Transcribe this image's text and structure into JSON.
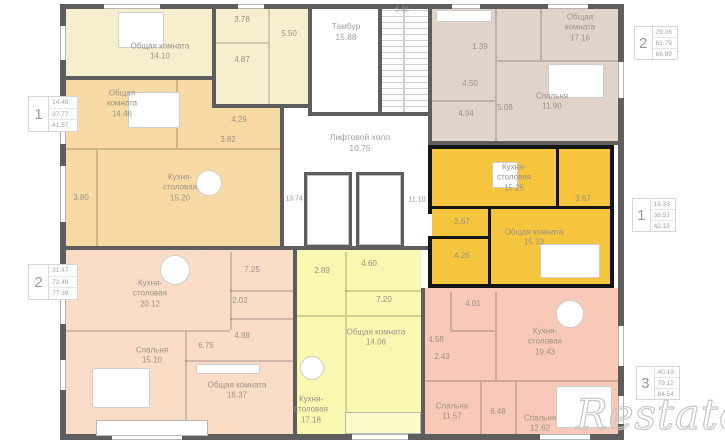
{
  "watermark": "Restate",
  "colors": {
    "selected_unit": "#f4c53d",
    "selected_walls": "#151515",
    "unit_cream": "#f6eecd",
    "unit_orange": "#f8dba4",
    "unit_pink": "#fbdcc6",
    "unit_yellow": "#f8f8b0",
    "unit_salmon": "#f8c9b8",
    "unit_beige": "#e2d3c8",
    "walls": "#5e5e5e",
    "label_text": "#9b9389"
  },
  "common_areas": {
    "tambour": {
      "name": "Тамбур",
      "area": "15.88"
    },
    "lift_hall": {
      "name": "Лифтовой холл",
      "area": "10.75"
    },
    "corridor_left_area": "13.74",
    "corridor_right_area": "11.10",
    "top_area": "5.40"
  },
  "units": [
    {
      "id": "cream-top-left",
      "rooms": [
        {
          "name": "Общая комната",
          "area": "14.10"
        },
        {
          "area": "3.78"
        },
        {
          "area": "4.87"
        },
        {
          "area": "5.50"
        }
      ]
    },
    {
      "id": "orange-mid-left",
      "rooms": [
        {
          "name": "Общая комната",
          "area": "14.46"
        },
        {
          "area": "4.29"
        },
        {
          "area": "3.82"
        },
        {
          "name": "Кухня-столовая",
          "area": "15.20"
        },
        {
          "area": "3.80"
        }
      ]
    },
    {
      "id": "pink-bottom-left",
      "rooms": [
        {
          "name": "Кухня-столовая",
          "area": "20.12"
        },
        {
          "area": "7.25"
        },
        {
          "area": "2.02"
        },
        {
          "area": "4.88"
        },
        {
          "area": "6.75"
        },
        {
          "name": "Спальня",
          "area": "15.10"
        },
        {
          "name": "Общая комната",
          "area": "16.37"
        }
      ]
    },
    {
      "id": "yellow-bottom-middle",
      "rooms": [
        {
          "area": "2.89"
        },
        {
          "area": "4.60"
        },
        {
          "area": "7.20"
        },
        {
          "name": "Общая комната",
          "area": "14.06"
        },
        {
          "name": "Кухня-столовая",
          "area": "17.18"
        }
      ]
    },
    {
      "id": "salmon-bottom-right",
      "rooms": [
        {
          "area": "4.01"
        },
        {
          "area": "4.58"
        },
        {
          "area": "2.43"
        },
        {
          "name": "Кухня-столовая",
          "area": "19.43"
        },
        {
          "name": "Спальня",
          "area": "11.57"
        },
        {
          "area": "8.48"
        },
        {
          "name": "Спальня",
          "area": "12.62"
        }
      ]
    },
    {
      "id": "beige-top-right",
      "rooms": [
        {
          "name": "Общая комната",
          "area": "17.16"
        },
        {
          "name": "Спальня",
          "area": "11.90"
        },
        {
          "area": "1.39"
        },
        {
          "area": "4.50"
        },
        {
          "area": "4.94"
        },
        {
          "area": "5.08"
        }
      ]
    },
    {
      "id": "selected-apartment",
      "rooms": [
        {
          "name": "Кухня-столовая",
          "area": "15.25"
        },
        {
          "area": "3.67"
        },
        {
          "area": "3.67"
        },
        {
          "area": "4.26"
        },
        {
          "name": "Общая комната",
          "area": "15.33"
        }
      ]
    }
  ],
  "info_cards": [
    {
      "rooms": "1",
      "values": [
        "14.46",
        "37.77",
        "41.57"
      ]
    },
    {
      "rooms": "2",
      "values": [
        "31.47",
        "72.49",
        "77.39"
      ]
    },
    {
      "rooms": "2",
      "values": [
        "29.06",
        "61.79",
        "66.89"
      ]
    },
    {
      "rooms": "1",
      "values": [
        "15.33",
        "38.51",
        "42.18"
      ]
    },
    {
      "rooms": "3",
      "values": [
        "40.19",
        "79.12",
        "84.54"
      ]
    }
  ]
}
